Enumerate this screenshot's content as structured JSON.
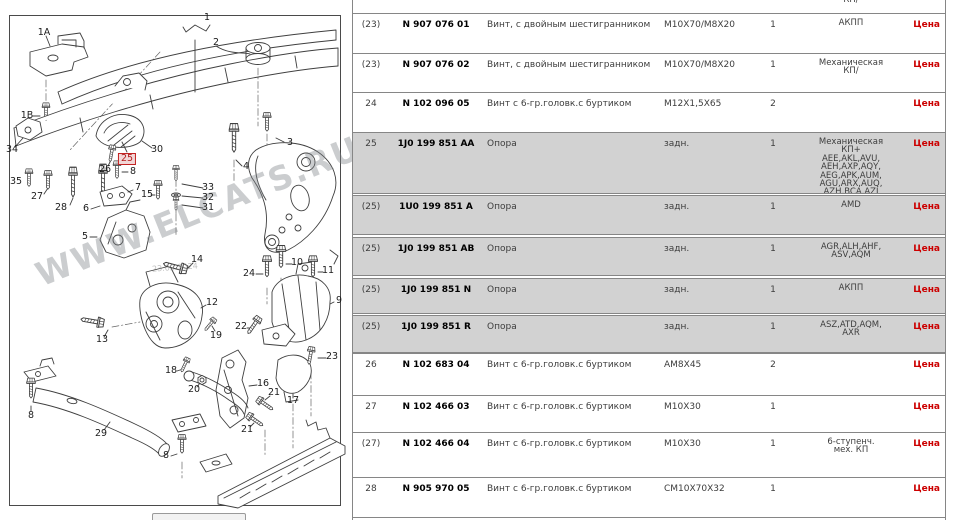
{
  "diagram": {
    "watermark": "WWW.ELCATS.RU",
    "date_watermark": "23.02.2024",
    "callouts": [
      {
        "n": "1A",
        "x": 44,
        "y": 33
      },
      {
        "n": "1B",
        "x": 27,
        "y": 116
      },
      {
        "n": "1",
        "x": 207,
        "y": 18
      },
      {
        "n": "2",
        "x": 216,
        "y": 43
      },
      {
        "n": "34",
        "x": 12,
        "y": 150
      },
      {
        "n": "35",
        "x": 16,
        "y": 182
      },
      {
        "n": "27",
        "x": 37,
        "y": 197
      },
      {
        "n": "28",
        "x": 61,
        "y": 208
      },
      {
        "n": "26",
        "x": 105,
        "y": 170
      },
      {
        "n": "25",
        "x": 127,
        "y": 159,
        "hl": true
      },
      {
        "n": "8",
        "x": 133,
        "y": 172
      },
      {
        "n": "7",
        "x": 138,
        "y": 188
      },
      {
        "n": "15",
        "x": 147,
        "y": 195
      },
      {
        "n": "30",
        "x": 157,
        "y": 150
      },
      {
        "n": "3",
        "x": 290,
        "y": 143
      },
      {
        "n": "4",
        "x": 246,
        "y": 167
      },
      {
        "n": "33",
        "x": 208,
        "y": 188
      },
      {
        "n": "32",
        "x": 208,
        "y": 198
      },
      {
        "n": "31",
        "x": 208,
        "y": 208
      },
      {
        "n": "6",
        "x": 86,
        "y": 209
      },
      {
        "n": "5",
        "x": 85,
        "y": 237
      },
      {
        "n": "14",
        "x": 197,
        "y": 260
      },
      {
        "n": "24",
        "x": 249,
        "y": 274
      },
      {
        "n": "10",
        "x": 297,
        "y": 263
      },
      {
        "n": "11",
        "x": 328,
        "y": 271
      },
      {
        "n": "9",
        "x": 339,
        "y": 301
      },
      {
        "n": "12",
        "x": 212,
        "y": 303
      },
      {
        "n": "13",
        "x": 102,
        "y": 340
      },
      {
        "n": "22",
        "x": 241,
        "y": 327
      },
      {
        "n": "19",
        "x": 216,
        "y": 336
      },
      {
        "n": "23",
        "x": 332,
        "y": 357
      },
      {
        "n": "16",
        "x": 263,
        "y": 384
      },
      {
        "n": "21",
        "x": 274,
        "y": 393
      },
      {
        "n": "17",
        "x": 293,
        "y": 401
      },
      {
        "n": "18",
        "x": 171,
        "y": 371
      },
      {
        "n": "20",
        "x": 194,
        "y": 390
      },
      {
        "n": "8",
        "x": 31,
        "y": 416
      },
      {
        "n": "29",
        "x": 101,
        "y": 434
      },
      {
        "n": "8",
        "x": 166,
        "y": 456
      },
      {
        "n": "21",
        "x": 247,
        "y": 430
      }
    ]
  },
  "table": {
    "rows": [
      {
        "pos": "",
        "part": "",
        "name": "",
        "size": "",
        "qty": "",
        "models": "КП/",
        "price": "",
        "gray": false,
        "partial": true,
        "top": 0,
        "h": 13
      },
      {
        "pos": "(23)",
        "part": "N 907 076 01",
        "name": "Винт, с двойным шестигранником",
        "size": "M10X70/M8X20",
        "qty": "1",
        "models": "АКПП",
        "price": "Цена",
        "gray": false,
        "top": 13,
        "h": 40
      },
      {
        "pos": "(23)",
        "part": "N 907 076 02",
        "name": "Винт, с двойным шестигранником",
        "size": "M10X70/M8X20",
        "qty": "1",
        "models": "Механическая\nКП/",
        "price": "Цена",
        "gray": false,
        "top": 53,
        "h": 39
      },
      {
        "pos": "24",
        "part": "N 102 096 05",
        "name": "Винт с 6-гр.головк.с буртиком",
        "size": "M12X1,5X65",
        "qty": "2",
        "models": "",
        "price": "Цена",
        "gray": false,
        "top": 92,
        "h": 40
      },
      {
        "pos": "25",
        "part": "1J0 199 851 AA",
        "name": "Опора",
        "size": "задн.",
        "qty": "1",
        "models": "Механическая\nКП+\nAEE,AKL,AVU,\nAEH,AXP,AQY,\nAEG,APK,AUM,\nAGU,ARX,AUQ,\nAZH,BCA,AZJ",
        "price": "Цена",
        "gray": true,
        "top": 132,
        "h": 62
      },
      {
        "pos": "(25)",
        "part": "1U0 199 851 A",
        "name": "Опора",
        "size": "задн.",
        "qty": "1",
        "models": "AMD",
        "price": "Цена",
        "gray": true,
        "top": 195,
        "h": 40
      },
      {
        "pos": "(25)",
        "part": "1J0 199 851 AB",
        "name": "Опора",
        "size": "задн.",
        "qty": "1",
        "models": "AGR,ALH,AHF,\nASV,AQM",
        "price": "Цена",
        "gray": true,
        "top": 237,
        "h": 39
      },
      {
        "pos": "(25)",
        "part": "1J0 199 851 N",
        "name": "Опора",
        "size": "задн.",
        "qty": "1",
        "models": "АКПП",
        "price": "Цена",
        "gray": true,
        "top": 278,
        "h": 36
      },
      {
        "pos": "(25)",
        "part": "1J0 199 851 R",
        "name": "Опора",
        "size": "задн.",
        "qty": "1",
        "models": "ASZ,ATD,AQM,\nAXR",
        "price": "Цена",
        "gray": true,
        "top": 315,
        "h": 38
      },
      {
        "pos": "26",
        "part": "N 102 683 04",
        "name": "Винт с 6-гр.головк.с буртиком",
        "size": "AM8X45",
        "qty": "2",
        "models": "",
        "price": "Цена",
        "gray": false,
        "top": 353,
        "h": 42
      },
      {
        "pos": "27",
        "part": "N 102 466 03",
        "name": "Винт с 6-гр.головк.с буртиком",
        "size": "M10X30",
        "qty": "1",
        "models": "",
        "price": "Цена",
        "gray": false,
        "top": 395,
        "h": 37
      },
      {
        "pos": "(27)",
        "part": "N 102 466 04",
        "name": "Винт с 6-гр.головк.с буртиком",
        "size": "M10X30",
        "qty": "1",
        "models": "6-ступенч.\nмех. КП",
        "price": "Цена",
        "gray": false,
        "top": 432,
        "h": 45
      },
      {
        "pos": "28",
        "part": "N 905 970 05",
        "name": "Винт с 6-гр.головк.с буртиком",
        "size": "CM10X70X32",
        "qty": "1",
        "models": "",
        "price": "Цена",
        "gray": false,
        "top": 477,
        "h": 41
      }
    ]
  }
}
